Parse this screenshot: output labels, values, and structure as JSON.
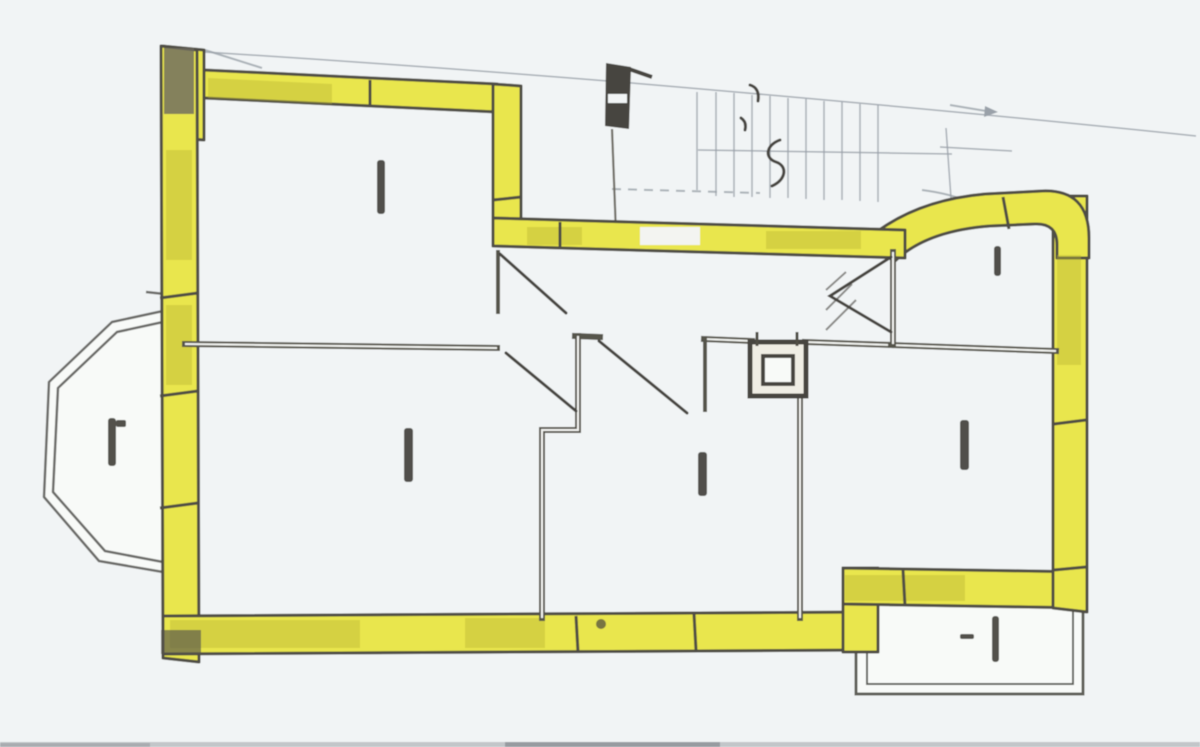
{
  "document": {
    "kind": "scanned hand-drawn apartment floor plan",
    "note": "walls of the apartment are highlighted yellow; staircase and annexes drawn in faint pencil; all handwritten room labels are tiny illegible marks"
  },
  "colors": {
    "paper": "#f1f4f5",
    "paper_bright": "#f8faf8",
    "wall_yellow": "#e9e64d",
    "wall_yellow_dark": "#b9b637",
    "wall_outline": "#4f4d44",
    "thin_wall": "#56544c",
    "thin_wall_gap": "#f3f4f1",
    "pencil_faint": "#9aa1a9",
    "pencil_dark": "#47453f",
    "ink_smudge": "#3a3933",
    "bay_outline": "#6b6b67",
    "scan_edge": "#c2c6c9",
    "scan_edge_dark": "#979ba0"
  },
  "rooms": [
    {
      "id": "top-left-room",
      "label_state": "illegible-handwritten-mark"
    },
    {
      "id": "middle-left-room",
      "label_state": "illegible-handwritten-mark"
    },
    {
      "id": "center-room",
      "label_state": "illegible-handwritten-mark"
    },
    {
      "id": "right-middle-room",
      "label_state": "illegible-handwritten-mark"
    },
    {
      "id": "top-right-small-room",
      "label_state": "illegible-handwritten-mark"
    },
    {
      "id": "hallway",
      "label_state": "none"
    },
    {
      "id": "bay-window-left",
      "label_state": "illegible-handwritten-mark"
    },
    {
      "id": "balcony-bottom-right",
      "label_state": "illegible-handwritten-mark"
    },
    {
      "id": "staircase-top",
      "label_state": "faint-pencil-squiggles"
    }
  ]
}
